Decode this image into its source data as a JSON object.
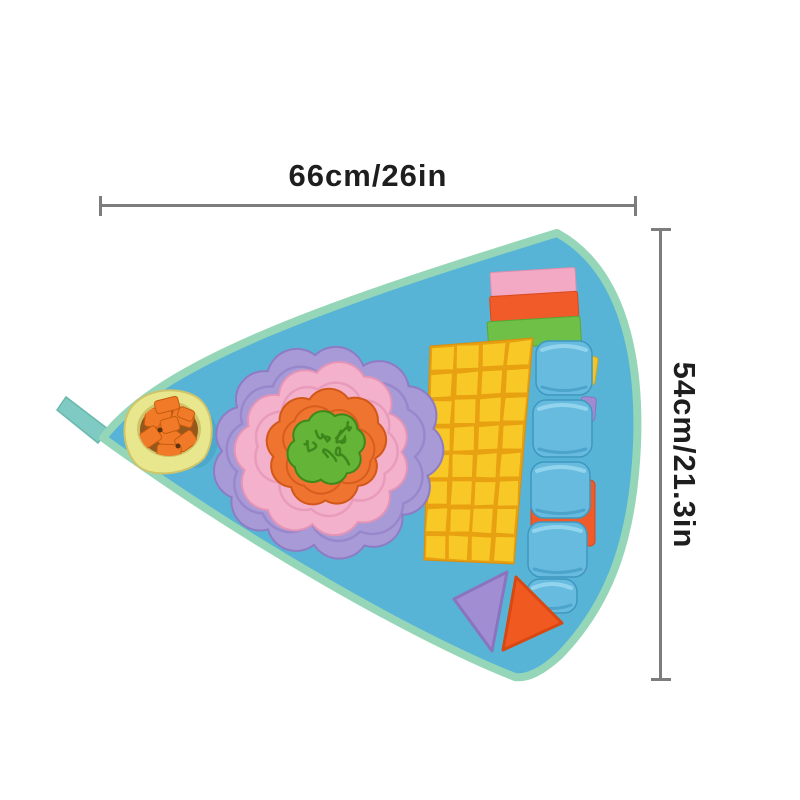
{
  "annotations": {
    "width_label": "66cm/26in",
    "height_label": "54cm/21.3in"
  },
  "colors": {
    "background": "#ffffff",
    "dimension_line": "#7d7d7d",
    "dimension_text": "#1e1e1e",
    "mat_base": "#57b4d6",
    "mat_trim": "#95d6b8",
    "hanging_loop": "#7fcac2",
    "bowl_body": "#e9e78d",
    "bowl_rim": "#cfc468",
    "bowl_inner": "#95571c",
    "treat_orange": "#f07a28",
    "treat_orange_dark": "#c65c0e",
    "flower_purple": "#a89ad6",
    "flower_purple_dark": "#8d7cc4",
    "flower_pink": "#f4b1cb",
    "flower_pink_dark": "#e494b6",
    "flower_orange": "#ee7430",
    "flower_orange_dark": "#d1581a",
    "flower_green": "#64b437",
    "flower_green_dark": "#3d871b",
    "patch_yellow": "#f8c826",
    "patch_shadow": "#e8a111",
    "loop_blue": "#66bbdf",
    "loop_blue_dark": "#3f97c0",
    "loop_blue_light": "#92d4ee",
    "strip_pink": "#f3a9c3",
    "strip_orange": "#f15b2a",
    "strip_green": "#6fc046",
    "peek_yellow": "#f2c42d",
    "peek_purple": "#a08bd0",
    "peek_pink": "#eba6c8",
    "triangle_purple": "#a18ed2",
    "triangle_orange": "#f05a20"
  }
}
